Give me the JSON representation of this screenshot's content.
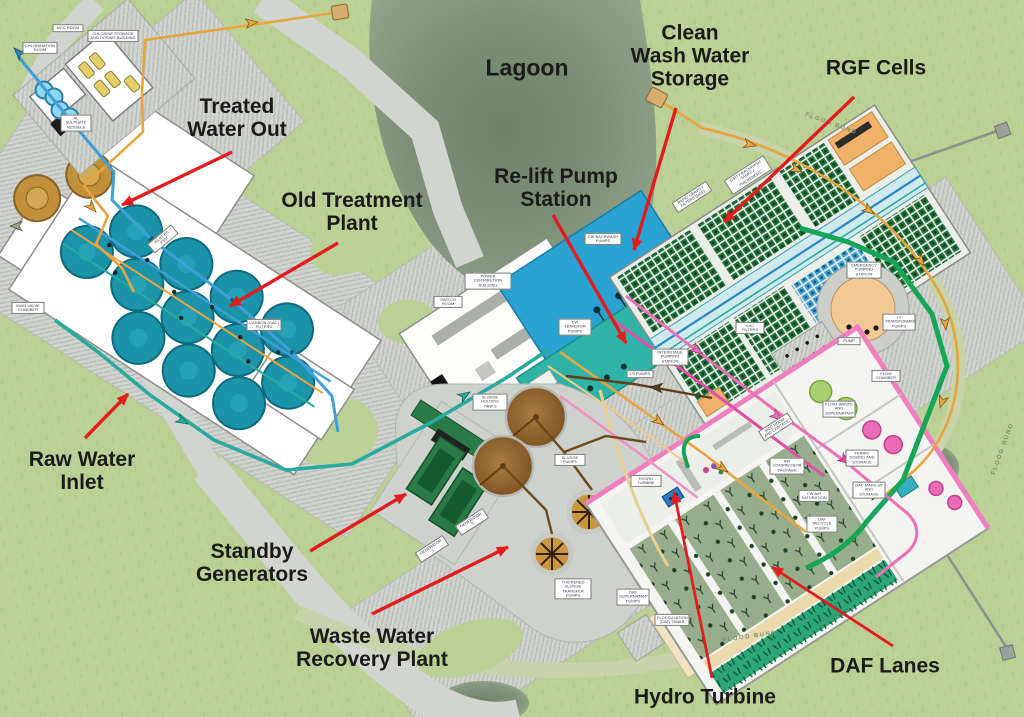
{
  "title": "Water treatment works annotated site plan",
  "colors": {
    "background_green": "#bad095",
    "lagoon_green": "#7d9077",
    "road_gray": "#d2d4cf",
    "flood_bund_road": "#c8d3ab",
    "annotation_text": "#1b1b1b",
    "annotation_arrow_red": "#e11d1d",
    "pipe_orange": "#e8a53f",
    "pipe_blue": "#3f9fd8",
    "pipe_teal": "#2aaa9e",
    "pipe_green": "#17a657",
    "pipe_pink": "#ef6fb7",
    "tank_teal": "#1b93a9",
    "tank_brown": "#8a5f2c",
    "daf_lane_green": "#97ad8b",
    "generator_green": "#2a7a46",
    "storage_blue": "#2aa3d2",
    "relift_teal": "#2fb3a6"
  },
  "annotations": [
    {
      "id": "treated-water-out",
      "lines": [
        "Treated",
        "Water Out"
      ]
    },
    {
      "id": "old-treatment-plant",
      "lines": [
        "Old Treatment",
        "Plant"
      ]
    },
    {
      "id": "lagoon",
      "lines": [
        "Lagoon"
      ]
    },
    {
      "id": "clean-wash-water-storage",
      "lines": [
        "Clean",
        "Wash Water",
        "Storage"
      ]
    },
    {
      "id": "rgf-cells",
      "lines": [
        "RGF Cells"
      ]
    },
    {
      "id": "relift-pump-station",
      "lines": [
        "Re-lift Pump",
        "Station"
      ]
    },
    {
      "id": "raw-water-inlet",
      "lines": [
        "Raw Water",
        "Inlet"
      ]
    },
    {
      "id": "standby-generators",
      "lines": [
        "Standby",
        "Generators"
      ]
    },
    {
      "id": "waste-water-recovery-plant",
      "lines": [
        "Waste Water",
        "Recovery Plant"
      ]
    },
    {
      "id": "hydro-turbine",
      "lines": [
        "Hydro Turbine"
      ]
    },
    {
      "id": "daf-lanes",
      "lines": [
        "DAF Lanes"
      ]
    }
  ],
  "flood_bund_label": "FLOOD BUND",
  "plan_labels": [
    {
      "text": "MCC ROOM"
    },
    {
      "text": "CHLORINE STORAGE AND DOSING BUILDING"
    },
    {
      "text": "CHLORINATION ROOM"
    },
    {
      "text": "AL SULPHATE VESSELS"
    },
    {
      "text": "MAIN VALVE CHAMBER"
    },
    {
      "text": "INLET PS PSM"
    },
    {
      "text": "CARBON (GAC) FILTERS"
    },
    {
      "text": "POWER DISTRIBUTION BUILDING"
    },
    {
      "text": "SWITCH ROOM"
    },
    {
      "text": "CW BACKWASH PUMPS"
    },
    {
      "text": "CW TRANSFER PUMPS"
    },
    {
      "text": "INTERSTAGE PUMPING STATION"
    },
    {
      "text": "LS PUMPS"
    },
    {
      "text": "DIRTY BACKWASH TANKS / THICKENERS"
    },
    {
      "text": "RAPID GRAVITY FILTERS (RGF)"
    },
    {
      "text": "GAC FILTERS"
    },
    {
      "text": "EMERGENCY PUMPING STATION"
    },
    {
      "text": "LV TRANSFORMER PUMPS"
    },
    {
      "text": "PUMP"
    },
    {
      "text": "FLOW CHAMBER"
    },
    {
      "text": "MCC ROOM AND CONTROL"
    },
    {
      "text": "HYDRO TURBINE"
    },
    {
      "text": "AIR COMPRESSOR PACKAGE"
    },
    {
      "text": "CW AIR SATURATION"
    },
    {
      "text": "DAF RECYCLE PUMPS"
    },
    {
      "text": "GAC MAKE-UP AND STORAGE"
    },
    {
      "text": "FLOAT WASTE AND SUPERNATANT"
    },
    {
      "text": "FERRIC DOSING AND STORAGE"
    },
    {
      "text": "SLUDGE HOLDING TANKS"
    },
    {
      "text": "SLUDGE PUMPS"
    },
    {
      "text": "THICKENED SLUDGE TRANSFER PUMPS"
    },
    {
      "text": "GENERATOR 1"
    },
    {
      "text": "GENERATOR 2"
    },
    {
      "text": "FLOCCULATION (DAF) TANKS"
    },
    {
      "text": "DAF SUPERNATANT PUMPS"
    }
  ]
}
